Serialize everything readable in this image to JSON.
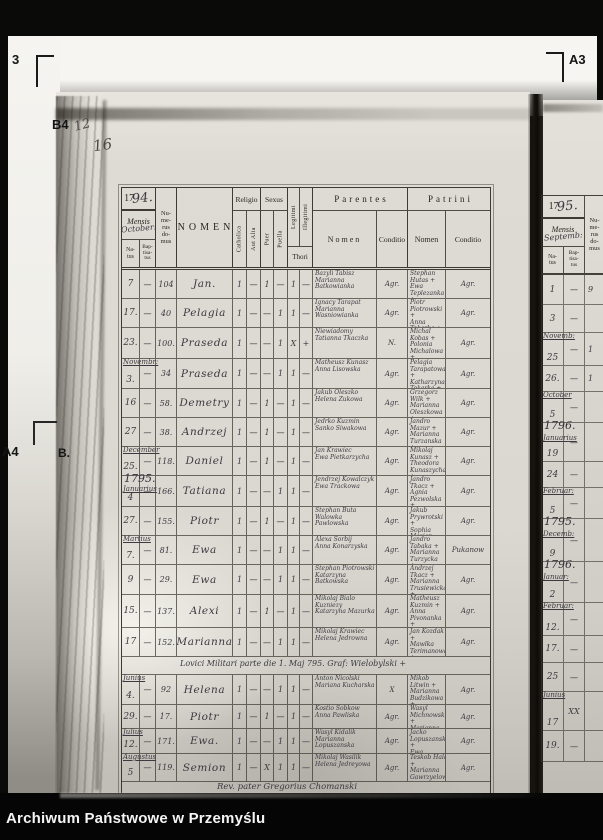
{
  "archive_bar": {
    "label": "Archiwum Państwowe w Przemyślu"
  },
  "film": {
    "markers": {
      "top_left": "3",
      "top_right": "A3",
      "left_b4": "B4",
      "left_a4": "A4",
      "left_b": "B."
    }
  },
  "pencil": {
    "mark1": "12",
    "mark2": "16"
  },
  "register": {
    "year_print": "17",
    "year_script": "94.",
    "header": {
      "mensis": "Mensis",
      "mensis_script": "October:",
      "natus": "Na-\ntus",
      "baptisatus": "Bap-\ntisa-\ntus",
      "numerus": "Nu-\nme-\nrus\ndo-\nmus",
      "nomen": "NOMEN",
      "religio": "Religio",
      "catholica": "Catholica",
      "aut_alia": "Aut Alia",
      "sexus": "Sexus",
      "puer": "Puer",
      "puella": "Puella",
      "legitimi": "Legitimi",
      "illegitimi": "Illegitimi",
      "thori": "Thori",
      "parentes": "Parentes",
      "parentes_nomen": "Nomen",
      "parentes_conditio": "Conditio",
      "patrini": "Patrini",
      "patrini_nomen": "Nomen",
      "patrini_conditio": "Conditio"
    },
    "rows": [
      {
        "h": 28,
        "natus": "7",
        "bapt": "—",
        "domus": "104",
        "name": "Jan.",
        "m": [
          "1",
          "—",
          "1",
          "—",
          "1",
          "—"
        ],
        "pn": "Bazyli Tabisz\nMarianna Batkowianka",
        "pc": "Agr.",
        "tn": "Stephan Hutas +\nEwa Teplezanka +",
        "tc": "Agr."
      },
      {
        "h": 28,
        "natus": "17.",
        "bapt": "—",
        "domus": "40",
        "name": "Pelagia",
        "m": [
          "1",
          "—",
          "—",
          "1",
          "1",
          "—"
        ],
        "pn": "Ignacy Tarapat\nMarianna Wasniowianka",
        "pc": "Agr.",
        "tn": "Piotr Piotrowski +\nAnna Tokarka +",
        "tc": "Agr."
      },
      {
        "h": 30,
        "natus": "23.",
        "bapt": "—",
        "domus": "100.",
        "name": "Praseda",
        "m": [
          "1",
          "—",
          "—",
          "1",
          "X",
          "+"
        ],
        "pn": "Niewiadomy\nTatianna Tkaczka",
        "pc": "N.",
        "tn": "Michal Kobas +\nPolonia Michalowa +",
        "tc": "Agr."
      },
      {
        "h": 29,
        "month": "Novembr:",
        "natus": "3.",
        "bapt": "—",
        "domus": "34",
        "name": "Praseda",
        "m": [
          "1",
          "—",
          "—",
          "1",
          "1",
          "—"
        ],
        "pn": "Matheusz Kunasz\nAnna Lisowska",
        "pc": "Agr.",
        "tn": "Pelagia Tarapatowa +\nKatharzyna Tokarka +",
        "tc": "Agr."
      },
      {
        "h": 28,
        "natus": "16",
        "bapt": "—",
        "domus": "58.",
        "name": "Demetry",
        "m": [
          "1",
          "—",
          "1",
          "—",
          "1",
          "—"
        ],
        "pn": "Jakub Oleszko\nHelena Zukowa",
        "pc": "Agr.",
        "tn": "Grzegorz Wilk +\nMarianna Oleszkowa +",
        "tc": "Agr."
      },
      {
        "h": 28,
        "natus": "27",
        "bapt": "—",
        "domus": "38.",
        "name": "Andrzej",
        "m": [
          "1",
          "—",
          "1",
          "—",
          "1",
          "—"
        ],
        "pn": "Jedrko Kuzmin\nSanko Siwakowa",
        "pc": "Agr.",
        "tn": "Jandro Mazur +\nMarianna Turzanska +",
        "tc": "Agr."
      },
      {
        "h": 28,
        "month": "December",
        "natus": "25.",
        "bapt": "—",
        "domus": "118.",
        "name": "Daniel",
        "m": [
          "1",
          "—",
          "1",
          "—",
          "1",
          "—"
        ],
        "pn": "Jan Krawiec\nEwa Pietkarzycha",
        "pc": "Agr.",
        "tn": "Mikolaj Kunasz +\nTheodora Kunaszycha +",
        "tc": "Agr."
      },
      {
        "h": 30,
        "year": "1795.",
        "month": "Januarius",
        "natus": "4",
        "bapt": "—",
        "domus": "166.",
        "name": "Tatiana",
        "m": [
          "1",
          "—",
          "—",
          "1",
          "1",
          "—"
        ],
        "pn": "Jendrzej Kowalczyk\nEwa Trackowa",
        "pc": "Agr.",
        "tn": "Jandro Tkacz +\nAgnia Pezwolska +",
        "tc": "Agr."
      },
      {
        "h": 28,
        "natus": "27.",
        "bapt": "—",
        "domus": "155.",
        "name": "Piotr",
        "m": [
          "1",
          "—",
          "1",
          "—",
          "1",
          "—"
        ],
        "pn": "Stephan Buta\nWalowka Pawlowska",
        "pc": "Agr.",
        "tn": "Jakub Prywrotski +\nSophia Maziar Kuwinska +",
        "tc": "Agr."
      },
      {
        "h": 28,
        "month": "Martius",
        "natus": "7.",
        "bapt": "—",
        "domus": "81.",
        "name": "Ewa",
        "m": [
          "1",
          "—",
          "—",
          "1",
          "1",
          "—"
        ],
        "pn": "Alexa Sorbij\nAnna Konarzyska",
        "pc": "Agr.",
        "tn": "Jandro Tabaka +\nMarianna Turzycka +",
        "tc": "Pukanow"
      },
      {
        "h": 29,
        "natus": "9",
        "bapt": "—",
        "domus": "29.",
        "name": "Ewa",
        "m": [
          "1",
          "—",
          "—",
          "1",
          "1",
          "—"
        ],
        "pn": "Stephan Piotrowski\nKatarzyna Batkowska",
        "pc": "Agr.",
        "tn": "Andrzej Tkacz +\nMarianna Trusiewicka +",
        "tc": "Agr."
      },
      {
        "h": 32,
        "natus": "15.",
        "bapt": "—",
        "domus": "137.",
        "name": "Alexi",
        "m": [
          "1",
          "—",
          "1",
          "—",
          "1",
          "—"
        ],
        "pn": "Mikolaj Bialo Kuzniezy\nKatarzyna Mazurka",
        "pc": "Agr.",
        "tn": "Matheusz Kuzmin +\nAnna Pivonanka +",
        "tc": "Agr."
      },
      {
        "h": 28,
        "natus": "17",
        "bapt": "—",
        "domus": "152.",
        "name": "Marianna",
        "m": [
          "1",
          "—",
          "—",
          "1",
          "1",
          "—"
        ],
        "pn": "Mikolaj Krawiec\nHelena Jedrowna",
        "pc": "Agr.",
        "tn": "Jan Kozdak +\nMawlka Terimanowa +",
        "tc": "Agr."
      },
      {
        "h": 17,
        "annotation": "Lovici Militari parte die 1. Maj 795. Graf: Wielobylski +"
      },
      {
        "h": 29,
        "month": "Junius",
        "natus": "4.",
        "bapt": "—",
        "domus": "92",
        "name": "Helena",
        "m": [
          "1",
          "—",
          "—",
          "1",
          "1",
          "—"
        ],
        "pn": "Anton Nicolski\nMariana Kucharska",
        "pc": "X",
        "tn": "Mikob Litwin +\nMarianna Budzikowa +",
        "tc": "Agr."
      },
      {
        "h": 23,
        "natus": "29.",
        "bapt": "—",
        "domus": "17.",
        "name": "Piotr",
        "m": [
          "1",
          "—",
          "1",
          "—",
          "1",
          "—"
        ],
        "pn": "Kostio Sobkow\nAnna Pawliska",
        "pc": "Agr.",
        "tn": "Wasyl Michnowski +\nMarianna Sobkowa +",
        "tc": "Agr."
      },
      {
        "h": 24,
        "month": "Julius",
        "natus": "12.",
        "bapt": "—",
        "domus": "171.",
        "name": "Ewa.",
        "m": [
          "1",
          "—",
          "—",
          "1",
          "1",
          "—"
        ],
        "pn": "Wasyl Kidalik\nMarianna Lopuszanska",
        "pc": "Agr.",
        "tn": "Jacko Lopuszanski +\nEwa Kidalikowa +",
        "tc": "Agr."
      },
      {
        "h": 27,
        "month": "Augustus",
        "natus": "5",
        "bapt": "—",
        "domus": "119.",
        "name": "Semion",
        "m": [
          "1",
          "—",
          "X",
          "1",
          "1",
          "—"
        ],
        "pn": "Mikolaj Wasilik\nHelena Jedreyowa",
        "pc": "Agr.",
        "tn": "Teskob Halat +\nMarianna Gawrzyelowa +",
        "tc": "Agr."
      }
    ],
    "footer": "Rev. pater Gregorius Chomanski"
  },
  "next_page": {
    "year_print": "17",
    "year_script": "95.",
    "header": {
      "mensis": "Mensis",
      "mensis_script": "Septemb:",
      "natus": "Na-\ntus",
      "baptisatus": "Bap-\ntisa-\ntus",
      "numerus": "Nu-\nme-\nrus\ndo-\nmus"
    },
    "rows": [
      {
        "h": 29,
        "day": "1",
        "dash": "—",
        "dom": "9"
      },
      {
        "h": 27,
        "day": "3",
        "dash": "—"
      },
      {
        "h": 32,
        "month": "Novemb:",
        "day": "25",
        "dash": "—",
        "dom": "1"
      },
      {
        "h": 25,
        "day": "26.",
        "dash": "—",
        "dom": "1"
      },
      {
        "h": 30,
        "month": "October",
        "day": "5",
        "dash": "—"
      },
      {
        "h": 38,
        "year": "1796.",
        "month": "Januarius",
        "day": "19",
        "dash": "—"
      },
      {
        "h": 25,
        "day": "24",
        "dash": "—"
      },
      {
        "h": 30,
        "month": "Februar:",
        "day": "5",
        "dash": "—"
      },
      {
        "h": 42,
        "year": "1795.",
        "month": "Decemb:",
        "day": "9",
        "dash": "—"
      },
      {
        "h": 40,
        "year": "1796.",
        "month": "Januar:",
        "day": "2",
        "dash": "—"
      },
      {
        "h": 32,
        "month": "Februar:",
        "day": "12.",
        "dash": "—"
      },
      {
        "h": 26,
        "day": "17.",
        "dash": "—"
      },
      {
        "h": 28,
        "day": "25",
        "dash": "—"
      },
      {
        "h": 38,
        "month": "Junius",
        "day": "17",
        "dash": "XX"
      },
      {
        "h": 30,
        "day": "19.",
        "dash": "—"
      }
    ]
  }
}
